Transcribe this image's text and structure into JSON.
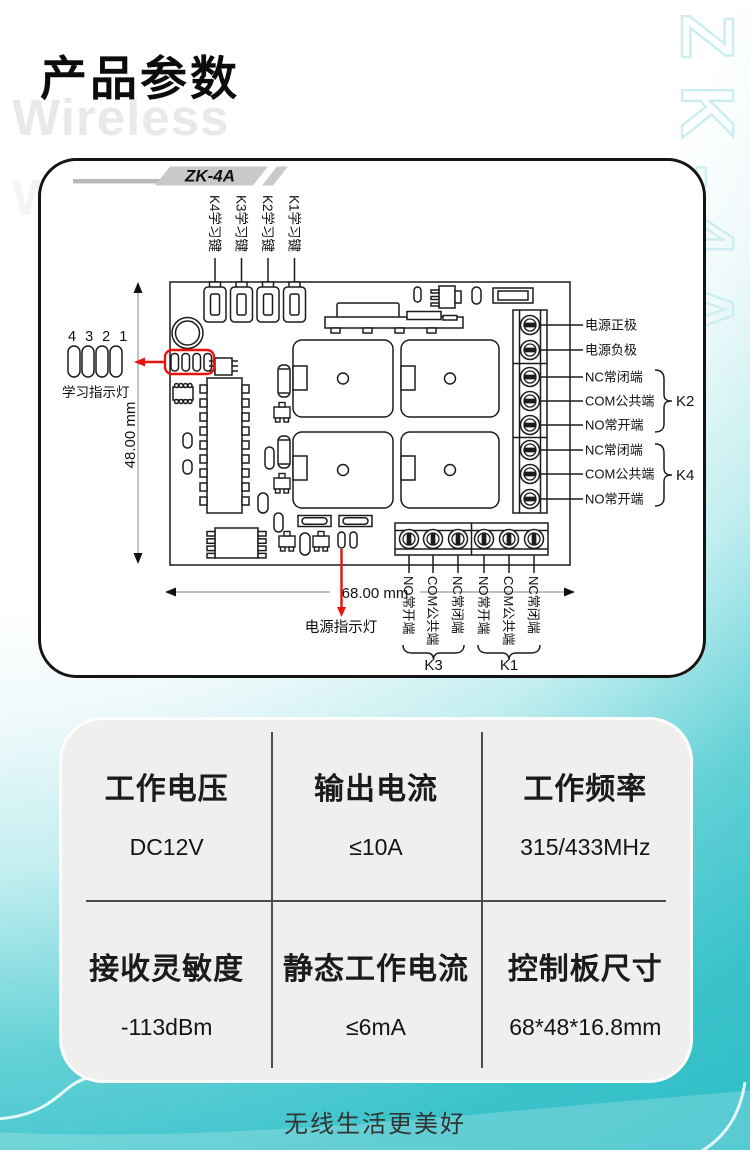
{
  "page": {
    "title": "产品参数",
    "watermark": "Wireless",
    "side_model": "ZK-4A",
    "tagline": "无线生活更美好"
  },
  "diagram": {
    "badge": "ZK-4A",
    "learning_keys": [
      "K4学习键",
      "K3学习键",
      "K2学习键",
      "K1学习键"
    ],
    "indicator_numbers": "4 3 2 1",
    "indicator_label": "学习指示灯",
    "height_dim": "48.00 mm",
    "width_dim": "68.00 mm",
    "power_led_label": "电源指示灯",
    "right_terminals": [
      "电源正极",
      "电源负极",
      "NC常闭端",
      "COM公共端",
      "NO常开端",
      "NC常闭端",
      "COM公共端",
      "NO常开端"
    ],
    "right_groups": [
      "K2",
      "K4"
    ],
    "bottom_terminals": [
      "NO常开端",
      "COM公共端",
      "NC常闭端",
      "NO常开端",
      "COM公共端",
      "NC常闭端"
    ],
    "bottom_groups": [
      "K3",
      "K1"
    ]
  },
  "specs": [
    {
      "label": "工作电压",
      "value": "DC12V"
    },
    {
      "label": "输出电流",
      "value": "≤10A"
    },
    {
      "label": "工作频率",
      "value": "315/433MHz"
    },
    {
      "label": "接收灵敏度",
      "value": "-113dBm"
    },
    {
      "label": "静态工作电流",
      "value": "≤6mA"
    },
    {
      "label": "控制板尺寸",
      "value": "68*48*16.8mm"
    }
  ],
  "colors": {
    "accent_teal": "#3ac2ca",
    "dimension_blue": "#2a6fc0",
    "highlight_red": "#e8130c",
    "badge_gray": "#c9c9c9"
  }
}
